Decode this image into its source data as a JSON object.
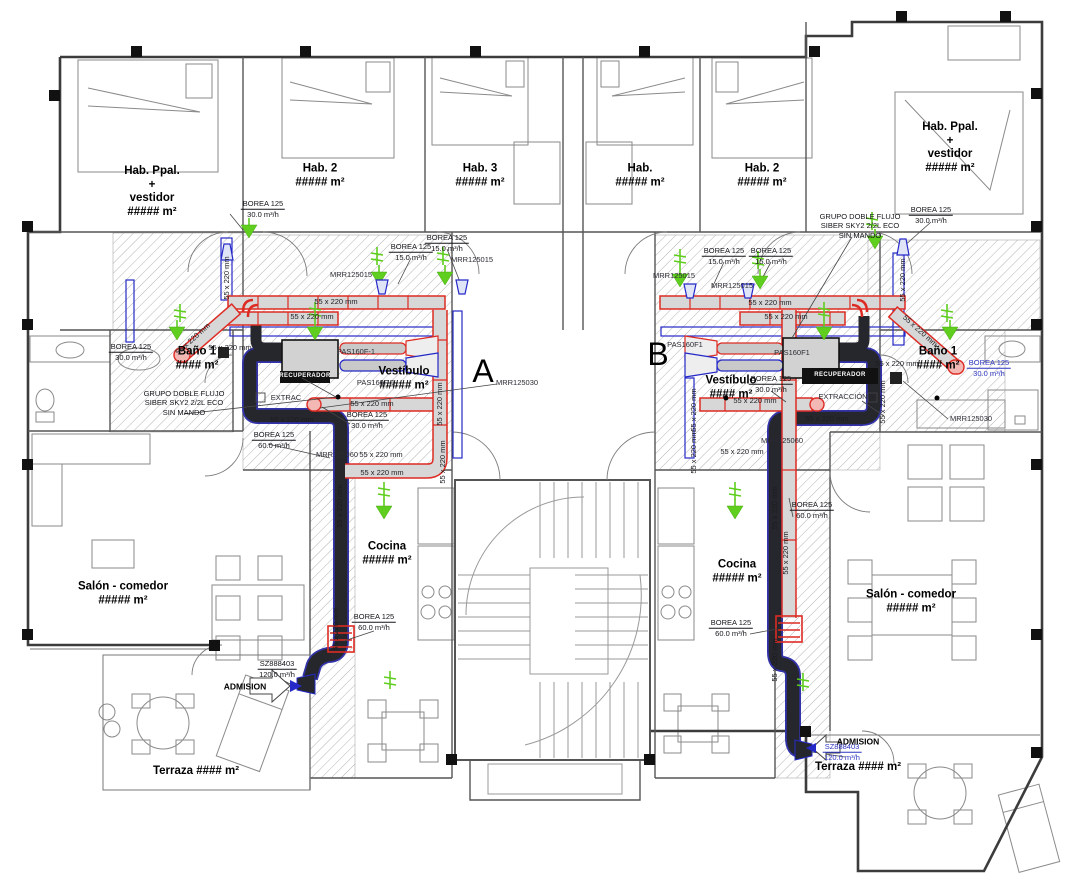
{
  "title": "Plano de ventilación - planta viviendas A y B",
  "colors": {
    "supply_duct_outline": "#dd2b23",
    "extract_duct": "#26262d",
    "aux_duct_blue": "#2529c8",
    "airflow_symbol_green": "#5fce1e",
    "duct_fill": "#d7d7d7",
    "wall": "#3c3c3c",
    "hatch": "#b0b0b0"
  },
  "labels": {
    "letters": [
      {
        "name": "apartment-letter-a",
        "x": 483,
        "y": 372,
        "text": "A"
      },
      {
        "name": "apartment-letter-b",
        "x": 658,
        "y": 355,
        "text": "B"
      }
    ],
    "rooms": [
      {
        "name": "room-hab-ppal-left",
        "x": 152,
        "y": 192,
        "lines": [
          "Hab. Ppal.",
          "+",
          "vestidor",
          "##### m²"
        ]
      },
      {
        "name": "room-hab2-left",
        "x": 320,
        "y": 176,
        "lines": [
          "Hab. 2",
          "##### m²"
        ]
      },
      {
        "name": "room-hab3-left",
        "x": 480,
        "y": 176,
        "lines": [
          "Hab. 3",
          "##### m²"
        ]
      },
      {
        "name": "room-hab-right",
        "x": 640,
        "y": 176,
        "lines": [
          "Hab.",
          "##### m²"
        ]
      },
      {
        "name": "room-hab2-right",
        "x": 762,
        "y": 176,
        "lines": [
          "Hab. 2",
          "##### m²"
        ]
      },
      {
        "name": "room-hab-ppal-right",
        "x": 950,
        "y": 148,
        "lines": [
          "Hab. Ppal.",
          "+",
          "vestidor",
          "##### m²"
        ]
      },
      {
        "name": "room-bano1-left",
        "x": 197,
        "y": 359,
        "lines": [
          "Baño 1",
          "#### m²"
        ]
      },
      {
        "name": "room-bano1-right",
        "x": 938,
        "y": 359,
        "lines": [
          "Baño 1",
          "#### m²"
        ]
      },
      {
        "name": "room-vestibulo-left",
        "x": 404,
        "y": 379,
        "lines": [
          "Vestíbulo",
          "##### m²"
        ]
      },
      {
        "name": "room-vestibulo-right",
        "x": 731,
        "y": 388,
        "lines": [
          "Vestíbulo",
          "#### m²"
        ]
      },
      {
        "name": "room-cocina-left",
        "x": 387,
        "y": 554,
        "lines": [
          "Cocina",
          "##### m²"
        ]
      },
      {
        "name": "room-cocina-right",
        "x": 737,
        "y": 572,
        "lines": [
          "Cocina",
          "##### m²"
        ]
      },
      {
        "name": "room-salon-left",
        "x": 123,
        "y": 594,
        "lines": [
          "Salón - comedor",
          "##### m²"
        ]
      },
      {
        "name": "room-salon-right",
        "x": 911,
        "y": 602,
        "lines": [
          "Salón - comedor",
          "##### m²"
        ]
      },
      {
        "name": "room-terraza-left",
        "x": 196,
        "y": 772,
        "lines": [
          "Terraza #### m²"
        ]
      },
      {
        "name": "room-terraza-right",
        "x": 858,
        "y": 768,
        "lines": [
          "Terraza #### m²"
        ]
      }
    ],
    "flow": [
      {
        "name": "flow-borea-habppal-left",
        "x": 263,
        "y": 209,
        "l1": "BOREA 125",
        "l2": "30.0 m³/h",
        "blue": false
      },
      {
        "name": "flow-borea-hab3-left",
        "x": 447,
        "y": 243,
        "l1": "BOREA 125",
        "l2": "15.0 m³/h",
        "blue": false
      },
      {
        "name": "flow-borea-hab2-left",
        "x": 411,
        "y": 252,
        "l1": "BOREA 125",
        "l2": "15.0 m³/h",
        "blue": false
      },
      {
        "name": "flow-borea-bano-left",
        "x": 131,
        "y": 352,
        "l1": "BOREA 125",
        "l2": "30.0 m³/h",
        "blue": false
      },
      {
        "name": "flow-borea-vest-left",
        "x": 367,
        "y": 420,
        "l1": "BOREA 125",
        "l2": "30.0 m³/h",
        "blue": false
      },
      {
        "name": "flow-borea60-left",
        "x": 274,
        "y": 440,
        "l1": "BOREA 125",
        "l2": "60.0 m³/h",
        "blue": false
      },
      {
        "name": "flow-borea60-cocina-left",
        "x": 374,
        "y": 622,
        "l1": "BOREA 125",
        "l2": "60.0 m³/h",
        "blue": false
      },
      {
        "name": "flow-admision-left",
        "x": 277,
        "y": 669,
        "l1": "SZ888403",
        "l2": "120.0 m³/h",
        "blue": false
      },
      {
        "name": "flow-borea-habppal-right",
        "x": 931,
        "y": 215,
        "l1": "BOREA 125",
        "l2": "30.0 m³/h",
        "blue": false
      },
      {
        "name": "flow-borea-hab-right1",
        "x": 724,
        "y": 256,
        "l1": "BOREA 125",
        "l2": "15.0 m³/h",
        "blue": false
      },
      {
        "name": "flow-borea-hab-right2",
        "x": 771,
        "y": 256,
        "l1": "BOREA 125",
        "l2": "15.0 m³/h",
        "blue": false
      },
      {
        "name": "flow-borea-vest-right",
        "x": 771,
        "y": 384,
        "l1": "BOREA 125",
        "l2": "30.0 m³/h",
        "blue": false
      },
      {
        "name": "flow-borea-bano-right",
        "x": 989,
        "y": 368,
        "l1": "BOREA 125",
        "l2": "30.0 m³/h",
        "blue": true
      },
      {
        "name": "flow-borea60-right",
        "x": 812,
        "y": 510,
        "l1": "BOREA 125",
        "l2": "60.0 m³/h",
        "blue": false
      },
      {
        "name": "flow-borea60-cocina-right",
        "x": 731,
        "y": 628,
        "l1": "BOREA 125",
        "l2": "60.0 m³/h",
        "blue": false
      },
      {
        "name": "flow-admision-right",
        "x": 842,
        "y": 752,
        "l1": "SZ888403",
        "l2": "120.0 m³/h",
        "blue": true
      }
    ],
    "notes": [
      {
        "name": "note-grupo-left",
        "x": 184,
        "y": 403,
        "lines": [
          "GRUPO DOBLE FLUJO",
          "SIBER SKY2 2/2L ECO",
          "SIN MANDO"
        ]
      },
      {
        "name": "note-grupo-right",
        "x": 860,
        "y": 226,
        "lines": [
          "GRUPO DOBLE FLUJO",
          "SIBER SKY2 2/2L ECO",
          "SIN MANDO"
        ]
      }
    ],
    "devices": [
      {
        "name": "dev-mrr125015-a1",
        "x": 472,
        "y": 260,
        "text": "MRR125015"
      },
      {
        "name": "dev-mrr125015-a2",
        "x": 351,
        "y": 275,
        "text": "MRR125015"
      },
      {
        "name": "dev-mrr125015-b1",
        "x": 674,
        "y": 276,
        "text": "MRR125015"
      },
      {
        "name": "dev-mrr125015-b2",
        "x": 732,
        "y": 286,
        "text": "MRR125015"
      },
      {
        "name": "dev-mrr125030-a",
        "x": 517,
        "y": 383,
        "text": "MRR125030"
      },
      {
        "name": "dev-mrr125030-b",
        "x": 971,
        "y": 419,
        "text": "MRR125030"
      },
      {
        "name": "dev-mrr125060-a",
        "x": 337,
        "y": 455,
        "text": "MRR125060"
      },
      {
        "name": "dev-mrr125060-b",
        "x": 782,
        "y": 441,
        "text": "MRR125060"
      },
      {
        "name": "dev-pas160f1-a1",
        "x": 356,
        "y": 352,
        "text": "PAS160F-1"
      },
      {
        "name": "dev-pas160f1-a2",
        "x": 376,
        "y": 383,
        "text": "PAS160F-1"
      },
      {
        "name": "dev-pas160f1-b1",
        "x": 792,
        "y": 353,
        "text": "PAS160F1"
      },
      {
        "name": "dev-pas160f1-b2",
        "x": 685,
        "y": 345,
        "text": "PAS160F1"
      },
      {
        "name": "dev-extrac-a",
        "x": 286,
        "y": 398,
        "text": "EXTRAC"
      },
      {
        "name": "dev-extraccion-b",
        "x": 843,
        "y": 397,
        "text": "EXTRACCIÓN"
      }
    ],
    "admission": [
      {
        "name": "admision-arrow-label-left",
        "x": 245,
        "y": 687,
        "text": "ADMISION"
      },
      {
        "name": "admision-arrow-label-right",
        "x": 858,
        "y": 742,
        "text": "ADMISION"
      }
    ],
    "unit_tags": [
      {
        "name": "unit-tag-left",
        "x": 305,
        "y": 377,
        "text": "RECUPERADOR"
      },
      {
        "name": "unit-tag-right",
        "x": 840,
        "y": 376,
        "text": "RECUPERADOR"
      }
    ],
    "sizes": [
      {
        "x": 336,
        "y": 302,
        "rot": 0,
        "text": "55 x 220 mm"
      },
      {
        "x": 312,
        "y": 317,
        "rot": 0,
        "text": "55 x 220 mm"
      },
      {
        "x": 193,
        "y": 339,
        "rot": -42,
        "text": "55 x 220 mm"
      },
      {
        "x": 230,
        "y": 348,
        "rot": 0,
        "text": "55 x 220 mm"
      },
      {
        "x": 372,
        "y": 404,
        "rot": 0,
        "text": "55 x 220 mm"
      },
      {
        "x": 292,
        "y": 420,
        "rot": 0,
        "text": "55 x 220 mm"
      },
      {
        "x": 381,
        "y": 455,
        "rot": 0,
        "text": "55 x 220 mm"
      },
      {
        "x": 382,
        "y": 473,
        "rot": 0,
        "text": "55 x 220 mm"
      },
      {
        "x": 227,
        "y": 278,
        "rot": -90,
        "text": "55 x 220 mm"
      },
      {
        "x": 440,
        "y": 404,
        "rot": -90,
        "text": "55 x 220 mm"
      },
      {
        "x": 443,
        "y": 462,
        "rot": -90,
        "text": "55 x 220 mm"
      },
      {
        "x": 340,
        "y": 506,
        "rot": -90,
        "text": "55 x 220 mm"
      },
      {
        "x": 336,
        "y": 629,
        "rot": -90,
        "text": "55 x 220 mm"
      },
      {
        "x": 770,
        "y": 303,
        "rot": 0,
        "text": "55 x 220 mm"
      },
      {
        "x": 786,
        "y": 317,
        "rot": 0,
        "text": "55 x 220 mm"
      },
      {
        "x": 920,
        "y": 331,
        "rot": 42,
        "text": "55 x 220 mm"
      },
      {
        "x": 755,
        "y": 401,
        "rot": 0,
        "text": "55 x 220 mm"
      },
      {
        "x": 827,
        "y": 419,
        "rot": 0,
        "text": "55 x 220 mm"
      },
      {
        "x": 742,
        "y": 452,
        "rot": 0,
        "text": "55 x 220 mm"
      },
      {
        "x": 775,
        "y": 508,
        "rot": -90,
        "text": "55 x 220 mm"
      },
      {
        "x": 786,
        "y": 553,
        "rot": -90,
        "text": "55 x 220 mm"
      },
      {
        "x": 775,
        "y": 660,
        "rot": -90,
        "text": "55 x 220 mm"
      },
      {
        "x": 883,
        "y": 402,
        "rot": -90,
        "text": "55 x 220 mm"
      },
      {
        "x": 694,
        "y": 410,
        "rot": -90,
        "text": "55 x 220 mm"
      },
      {
        "x": 694,
        "y": 452,
        "rot": -90,
        "text": "55 x 220 mm"
      },
      {
        "x": 903,
        "y": 280,
        "rot": -90,
        "text": "55 x 220 mm"
      },
      {
        "x": 897,
        "y": 364,
        "rot": 0,
        "text": "55 x 220 mm"
      }
    ]
  }
}
